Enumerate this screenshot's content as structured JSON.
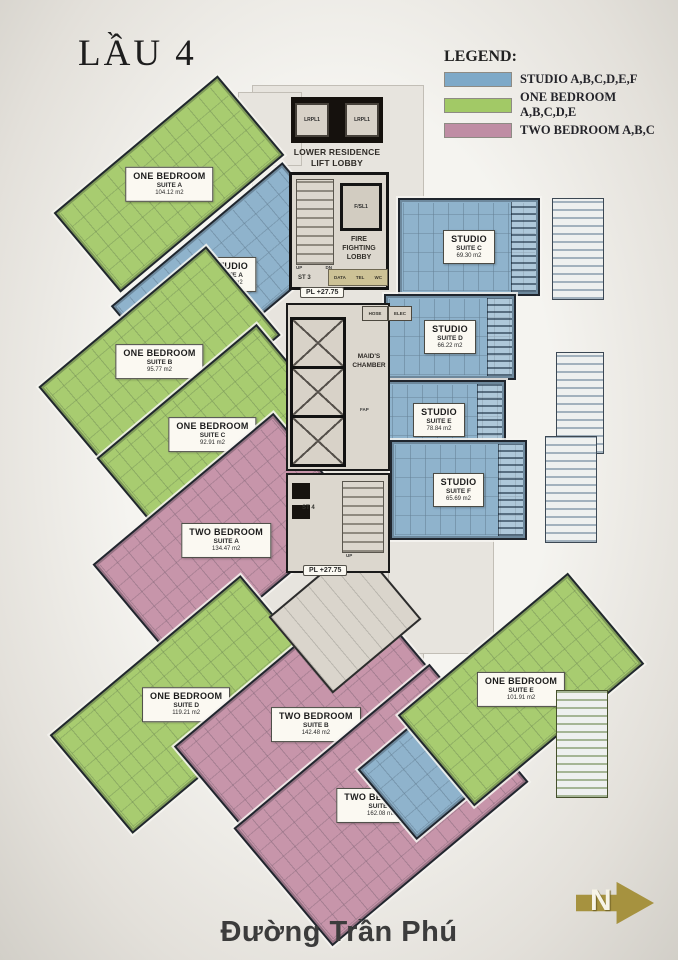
{
  "title": "LẦU 4",
  "legend": {
    "heading": "LEGEND:",
    "items": [
      {
        "label": "STUDIO A,B,C,D,E,F",
        "color": "#7ea9c8"
      },
      {
        "label": "ONE BEDROOM A,B,C,D,E",
        "color": "#a2c966"
      },
      {
        "label": "TWO BEDROOM A,B,C",
        "color": "#bf8da4"
      }
    ]
  },
  "colors": {
    "blue": "#8fb3cc",
    "green": "#a8cc70",
    "pink": "#c795aa"
  },
  "units": [
    {
      "type": "ONE BEDROOM",
      "suite": "SUITE A",
      "area": "104.12 m2",
      "category": "green"
    },
    {
      "type": "STUDIO",
      "suite": "SUITE A",
      "area": "82.67 m2",
      "category": "blue"
    },
    {
      "type": "ONE BEDROOM",
      "suite": "SUITE B",
      "area": "95.77 m2",
      "category": "green"
    },
    {
      "type": "ONE BEDROOM",
      "suite": "SUITE C",
      "area": "92.91 m2",
      "category": "green"
    },
    {
      "type": "TWO BEDROOM",
      "suite": "SUITE A",
      "area": "134.47 m2",
      "category": "pink"
    },
    {
      "type": "ONE BEDROOM",
      "suite": "SUITE D",
      "area": "119.21 m2",
      "category": "green"
    },
    {
      "type": "TWO BEDROOM",
      "suite": "SUITE B",
      "area": "142.48 m2",
      "category": "pink"
    },
    {
      "type": "TWO BEDROOM",
      "suite": "SUITE C",
      "area": "162.08 m2",
      "category": "pink"
    },
    {
      "type": "STUDIO",
      "suite": "SUITE B",
      "area": "59.10 m2",
      "category": "blue"
    },
    {
      "type": "ONE BEDROOM",
      "suite": "SUITE E",
      "area": "101.91 m2",
      "category": "green"
    },
    {
      "type": "STUDIO",
      "suite": "SUITE C",
      "area": "69.30 m2",
      "category": "blue"
    },
    {
      "type": "STUDIO",
      "suite": "SUITE D",
      "area": "66.22 m2",
      "category": "blue"
    },
    {
      "type": "STUDIO",
      "suite": "SUITE E",
      "area": "78.84 m2",
      "category": "blue"
    },
    {
      "type": "STUDIO",
      "suite": "SUITE F",
      "area": "65.69 m2",
      "category": "blue"
    }
  ],
  "core": {
    "lift_label": "LRPL1",
    "lobby": "LOWER RESIDENCE\nLIFT LOBBY",
    "fire_lift": "F/SL1",
    "fire_lobby": "FIRE\nFIGHTING\nLOBBY",
    "st3": "ST 3",
    "st4": "ST 4",
    "up": "UP",
    "dn": "DN",
    "maids": "MAID'S\nCHAMBER",
    "level": "PL +27.75",
    "room_data": "DATA",
    "room_tel": "TEL",
    "room_wc": "WC",
    "room_hose": "HOSE",
    "room_elec": "ELEC",
    "room_fap": "FAP"
  },
  "street": "Đường Trần Phú",
  "compass": {
    "letter": "N"
  }
}
